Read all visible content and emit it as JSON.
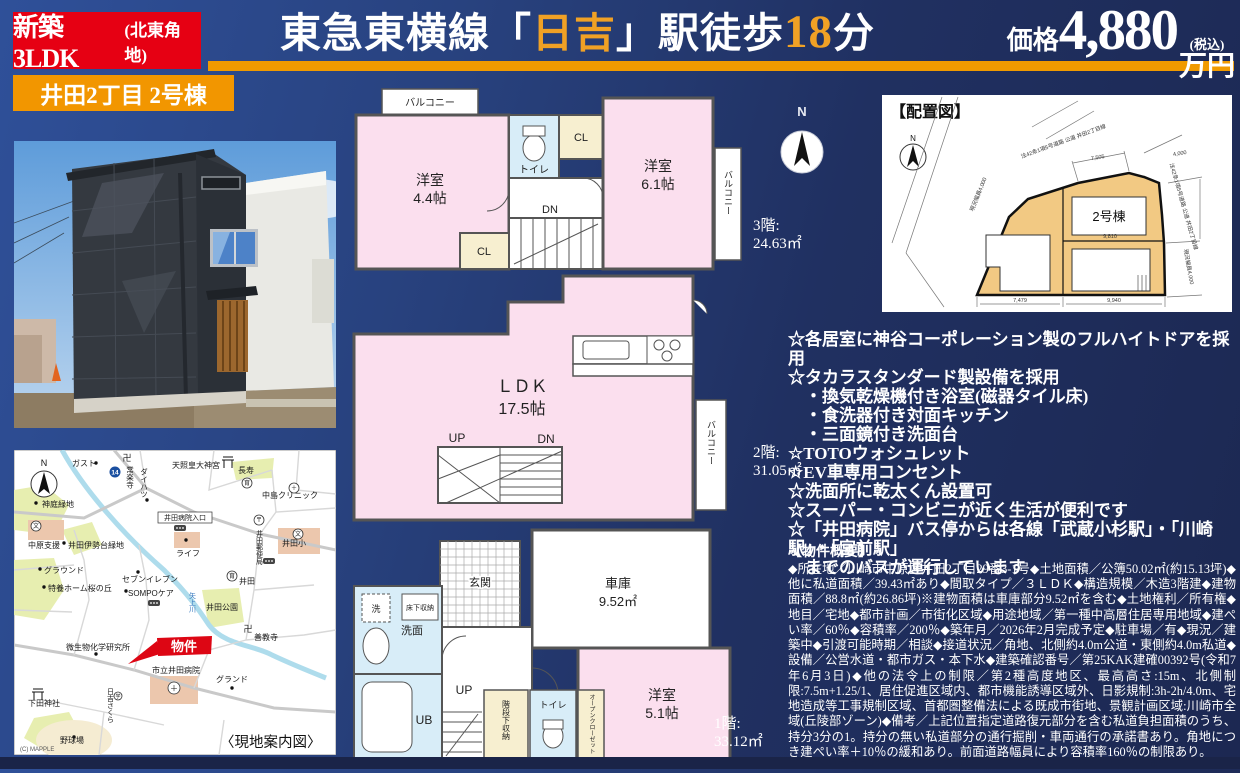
{
  "badges": {
    "new_main": "新築3LDK",
    "new_sub": "(北東角地)",
    "location": "井田2丁目 2号棟"
  },
  "header": {
    "s1": "東急東横線「",
    "station": "日吉",
    "s2": "」駅徒歩",
    "minutes": "18",
    "s3": "分"
  },
  "price": {
    "label": "価格",
    "amount": "4,880",
    "unit": "万円",
    "tax_note": "(税込)"
  },
  "compass": {
    "n": "N"
  },
  "floors": {
    "f3": {
      "label": "3階:",
      "area": "24.63㎡",
      "balcony1": "バルコニー",
      "toilet": "トイレ",
      "cl1": "CL",
      "cl2": "CL",
      "room1": "洋室",
      "room1_size": "4.4帖",
      "dn": "DN",
      "room2": "洋室",
      "room2_size": "6.1帖",
      "balcony2": "バルコニー"
    },
    "f2": {
      "label": "2階:",
      "area": "31.05㎡",
      "ldk": "ＬＤＫ",
      "ldk_size": "17.5帖",
      "up": "UP",
      "dn": "DN",
      "balcony": "バルコニー"
    },
    "f1": {
      "label": "1階:",
      "area": "33.12㎡",
      "garage": "車庫",
      "garage_size": "9.52㎡",
      "entrance": "玄関",
      "washer": "洗",
      "underfloor": "床下収納",
      "washroom": "洗面",
      "ub": "UB",
      "up": "UP",
      "stair_storage": "階段下収納",
      "toilet": "トイレ",
      "closet": "オープンクローゼット",
      "room": "洋室",
      "room_size": "5.1帖"
    }
  },
  "site_plan": {
    "title": "【配置図】",
    "building": "2号棟",
    "dims": [
      "7,505",
      "4,000",
      "9,810",
      "7,479",
      "9,940",
      "現況幅員4,000",
      "現況幅員4,000"
    ],
    "roads": [
      "法42条1項5号道路 公道 井田2丁目線",
      "法42条1項5号道路 公道 井田2丁目線"
    ]
  },
  "features": {
    "items": [
      "☆各居室に神谷コーポレーション製のフルハイトドアを採用",
      "☆タカラスタンダード製設備を採用",
      "・換気乾燥機付き浴室(磁器タイル床)",
      "・食洗器付き対面キッチン",
      "・三面鏡付き洗面台",
      "☆TOTOウォシュレット",
      "☆EV車専用コンセント",
      "☆洗面所に乾太くん設置可",
      "☆スーパー・コンビニが近く生活が便利です",
      "☆「井田病院」バス停からは各線「武蔵小杉駅」・「川崎駅」・「宮前駅」",
      "までのバスが運行しています"
    ]
  },
  "overview": {
    "title": "【物件概要】",
    "body": "◆所在地／川崎市中原区井田2丁目29番3-1号◆土地面積／公簿50.02㎡(約15.13坪)◆他に私道面積／39.43㎡あり◆間取タイプ／３ＬＤＫ◆構造規模／木造3階建◆建物面積／88.8㎡(約26.86坪)※建物面積は車庫部分9.52㎡を含む◆土地権利／所有権◆地目／宅地◆都市計画／市街化区域◆用途地域／第一種中高層住居専用地域◆建ぺい率／60％◆容積率／200％◆築年月／2026年2月完成予定◆駐車場／有◆現況／建築中◆引渡可能時期／相談◆接道状況／角地、北側約4.0m公道・東側約4.0m私道◆設備／公営水道・都市ガス・本下水◆建築確認番号／第25KAK建確00392号(令和7年6月3日)◆他の法令上の制限／第2種高度地区、最高高さ:15m、北側制限:7.5m+1.25/1、居住促進区域内、都市機能誘導区域外、日影規制:3h-2h/4.0m、宅地造成等工事規制区域、首都圏整備法による既成市街地、景観計画区域:川崎市全域(丘陵部ゾーン)◆備考／上記位置指定道路復元部分を含む私道負担面積のうち、持分3分の1。持分の無い私道部分の通行掘削・車両通行の承諾書あり。角地につき建ぺい率＋10％の緩和あり。前面道路幅員により容積率160％の制限あり。"
  },
  "map": {
    "caption": "〈現地案内図〉",
    "copyright": "(C) MAPPLE",
    "property": "物件",
    "river": "矢上川",
    "route": "14",
    "manji": "卍",
    "labels": [
      "ガスト",
      "常楽寺",
      "ダイハツ",
      "天照皇大神宮",
      "長寿",
      "中島クリニック",
      "神庭緑地",
      "中原支援",
      "井田伊勢台緑地",
      "井田病院入口",
      "ライフ",
      "井田郵便局",
      "井田小",
      "グラウンド",
      "特養ホーム桜の丘",
      "セブンイレブン",
      "SOMPOケア",
      "井田",
      "井田公園",
      "善教寺",
      "微生物化学研究所",
      "市立井田病院",
      "グランド",
      "日吉さくら",
      "下田神社",
      "野球場"
    ]
  }
}
